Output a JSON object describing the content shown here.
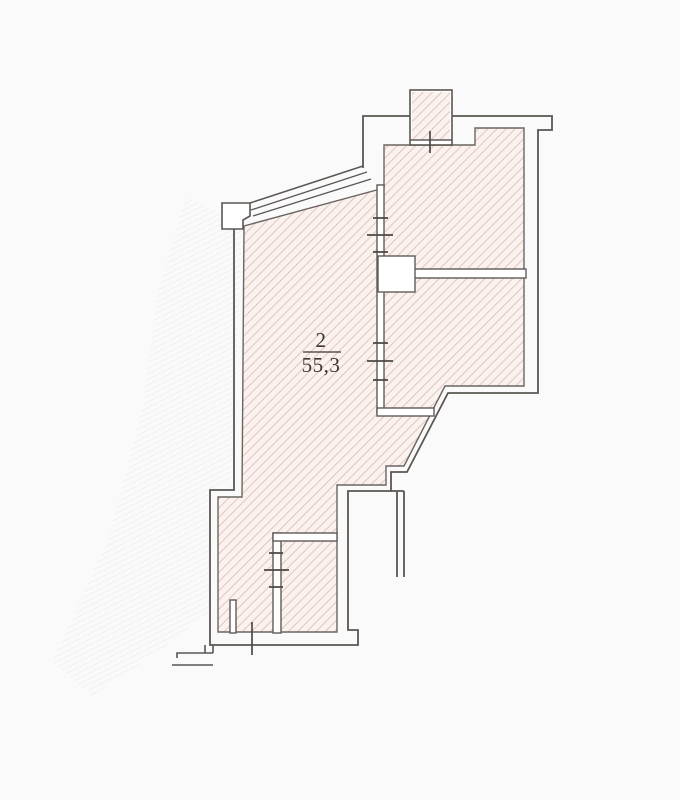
{
  "plan": {
    "kind": "apartment-floor-plan-scan",
    "room_number": "2",
    "area_label": "55,3",
    "area_units_implied": "m2"
  },
  "colors": {
    "page_bg": "#fbfafa",
    "hatch_bg": "#f9f2ef",
    "hatch_line": "#e0bdb4",
    "outline": "#5b5652",
    "wall_fill": "#ffffff",
    "tick": "#4c4845",
    "label": "#3b3734",
    "smudge": "#b7b2c6"
  },
  "features": {
    "rooms_hatched": 4,
    "door_opening_ticks": 4,
    "window_band": "top-left sloped glazing, 4 parallel lines",
    "vent_shaft": "small hatched rectangle protruding above top wall"
  }
}
